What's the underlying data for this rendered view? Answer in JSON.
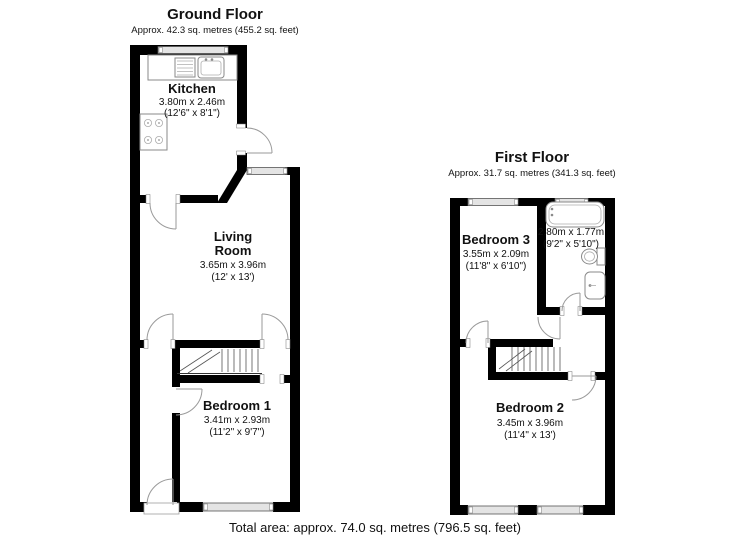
{
  "ground_floor": {
    "title": "Ground Floor",
    "subtitle": "Approx. 42.3 sq. metres (455.2 sq. feet)",
    "kitchen": {
      "name": "Kitchen",
      "dims_metric": "3.80m x 2.46m",
      "dims_imperial": "(12'6\" x 8'1\")"
    },
    "living_room": {
      "name_line1": "Living",
      "name_line2": "Room",
      "dims_metric": "3.65m x 3.96m",
      "dims_imperial": "(12' x 13')"
    },
    "bedroom_1": {
      "name": "Bedroom 1",
      "dims_metric": "3.41m x 2.93m",
      "dims_imperial": "(11'2\" x 9'7\")"
    }
  },
  "first_floor": {
    "title": "First Floor",
    "subtitle": "Approx. 31.7 sq. metres (341.3 sq. feet)",
    "bedroom_3": {
      "name": "Bedroom 3",
      "dims_metric": "3.55m x 2.09m",
      "dims_imperial": "(11'8\" x 6'10\")"
    },
    "bathroom": {
      "dims_metric": "2.80m x 1.77m",
      "dims_imperial": "(9'2\" x 5'10\")"
    },
    "bedroom_2": {
      "name": "Bedroom 2",
      "dims_metric": "3.45m x 3.96m",
      "dims_imperial": "(11'4\" x 13')"
    }
  },
  "footer": {
    "total_area": "Total area: approx. 74.0 sq. metres (796.5 sq. feet)"
  },
  "colors": {
    "wall": "#000000",
    "window_fill": "#e4e4e4",
    "door_arc": "#9a9a9a",
    "fixture_stroke": "#8a8a8a"
  }
}
